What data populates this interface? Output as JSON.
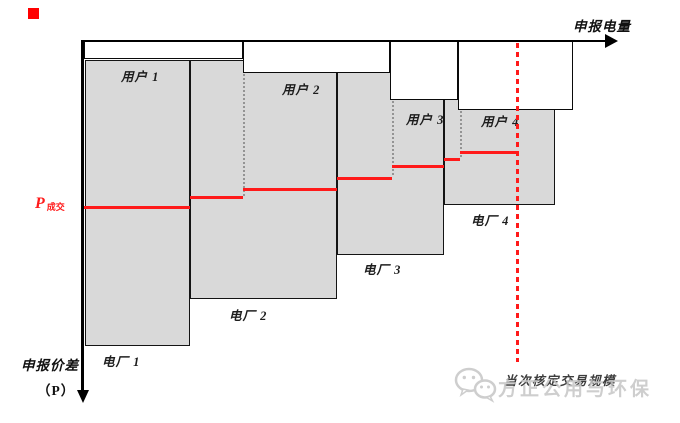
{
  "labels": {
    "axis_x": "申报电量",
    "axis_y": "申报价差",
    "axis_y_sub": "（P）",
    "price_main": "P",
    "price_sub": "成交",
    "scale_label": "当次核定交易规模"
  },
  "watermark": {
    "icon": "wechat-icon",
    "text": "方正公用与环保"
  },
  "colors": {
    "block_fill": "#d9d9d9",
    "block_border": "#141414",
    "red": "#ff1a1a",
    "dotted_guide": "#949494",
    "watermark_gray": "#c6c6c6",
    "marker_red": "#ff0000"
  },
  "diagram": {
    "supply_blocks": [
      {
        "name": "电厂 1",
        "x": 85,
        "y": 60,
        "w": 105,
        "h": 286,
        "label_x": 102,
        "label_y": 351
      },
      {
        "name": "电厂 2",
        "x": 190,
        "y": 60,
        "w": 147,
        "h": 239,
        "label_x": 229,
        "label_y": 305
      },
      {
        "name": "电厂 3",
        "x": 337,
        "y": 60,
        "w": 107,
        "h": 195,
        "label_x": 363,
        "label_y": 259
      },
      {
        "name": "电厂 4",
        "x": 444,
        "y": 60,
        "w": 111,
        "h": 145,
        "label_x": 471,
        "label_y": 210
      }
    ],
    "demand_boxes": [
      {
        "name": "用户 1",
        "x": 84,
        "y": 41,
        "w": 159,
        "h": 18,
        "label_x": 121,
        "label_y": 66
      },
      {
        "name": "用户 2",
        "x": 243,
        "y": 41,
        "w": 147,
        "h": 32,
        "label_x": 282,
        "label_y": 79
      },
      {
        "name": "用户 3",
        "x": 390,
        "y": 41,
        "w": 68,
        "h": 59,
        "label_x": 406,
        "label_y": 109
      },
      {
        "name": "用户 4",
        "x": 458,
        "y": 41,
        "w": 115,
        "h": 69,
        "label_x": 481,
        "label_y": 111
      }
    ],
    "price_segments": [
      {
        "x1": 84,
        "x2": 190,
        "y": 206
      },
      {
        "x1": 190,
        "x2": 243,
        "y": 196
      },
      {
        "x1": 243,
        "x2": 337,
        "y": 188
      },
      {
        "x1": 337,
        "x2": 392,
        "y": 177
      },
      {
        "x1": 392,
        "x2": 444,
        "y": 165
      },
      {
        "x1": 444,
        "x2": 460,
        "y": 158
      },
      {
        "x1": 460,
        "x2": 519,
        "y": 151
      }
    ],
    "dotted_guides": [
      {
        "x": 243,
        "y1": 74,
        "y2": 196
      },
      {
        "x": 392,
        "y1": 101,
        "y2": 177
      },
      {
        "x": 460,
        "y1": 111,
        "y2": 157
      }
    ],
    "dashed_line": {
      "x": 516,
      "y1": 43,
      "y2": 362
    }
  }
}
